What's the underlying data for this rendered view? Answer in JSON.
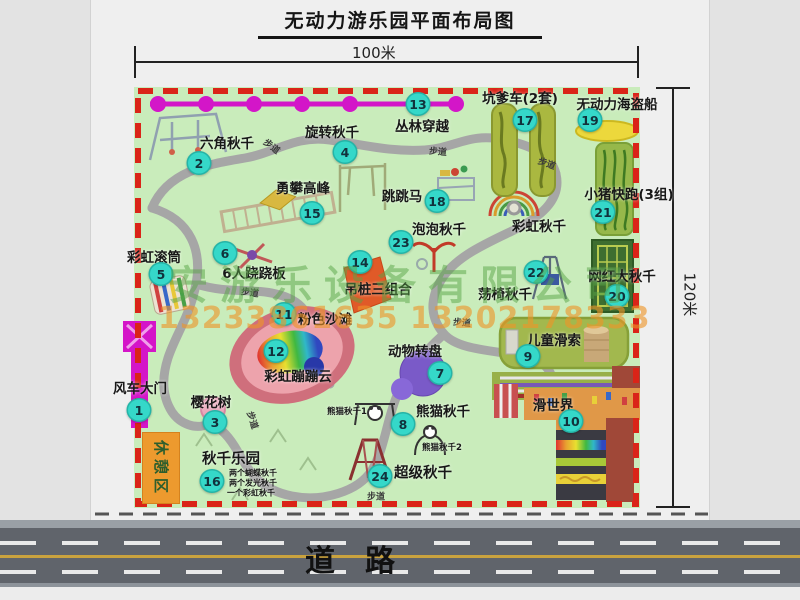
{
  "title": "无动力游乐园平面布局图",
  "dims": {
    "top": "100米",
    "right": "120米"
  },
  "watermark": {
    "company": "安游乐设备有限公司",
    "phone": "13233861635 13202178333"
  },
  "road": {
    "label": "道　路"
  },
  "rest_area": {
    "label": "休憩区"
  },
  "colors": {
    "park_green": "#c9ecbb",
    "border_red": "#da2418",
    "marker_teal": "#35d8c9",
    "zipline_magenta": "#d316c8",
    "gate_magenta": "#d415c8",
    "road_gray": "#60646b",
    "rest_orange": "#ed9a2e",
    "watermark_green": "#58a346",
    "watermark_orange": "#ee9428"
  },
  "map": {
    "markers": [
      {
        "n": "1",
        "x": 139,
        "y": 410
      },
      {
        "n": "2",
        "x": 199,
        "y": 163
      },
      {
        "n": "3",
        "x": 215,
        "y": 422
      },
      {
        "n": "4",
        "x": 345,
        "y": 152
      },
      {
        "n": "5",
        "x": 161,
        "y": 274
      },
      {
        "n": "6",
        "x": 225,
        "y": 253
      },
      {
        "n": "7",
        "x": 440,
        "y": 373
      },
      {
        "n": "8",
        "x": 403,
        "y": 424
      },
      {
        "n": "9",
        "x": 528,
        "y": 356
      },
      {
        "n": "10",
        "x": 571,
        "y": 421
      },
      {
        "n": "11",
        "x": 284,
        "y": 314
      },
      {
        "n": "12",
        "x": 276,
        "y": 351
      },
      {
        "n": "13",
        "x": 418,
        "y": 104
      },
      {
        "n": "14",
        "x": 360,
        "y": 262
      },
      {
        "n": "15",
        "x": 312,
        "y": 213
      },
      {
        "n": "16",
        "x": 212,
        "y": 481
      },
      {
        "n": "17",
        "x": 525,
        "y": 120
      },
      {
        "n": "18",
        "x": 437,
        "y": 201
      },
      {
        "n": "19",
        "x": 590,
        "y": 120
      },
      {
        "n": "20",
        "x": 617,
        "y": 296
      },
      {
        "n": "21",
        "x": 603,
        "y": 212
      },
      {
        "n": "22",
        "x": 536,
        "y": 272
      },
      {
        "n": "23",
        "x": 401,
        "y": 242
      },
      {
        "n": "24",
        "x": 380,
        "y": 476
      }
    ],
    "labels": [
      {
        "t": "六角秋千",
        "x": 227,
        "y": 142
      },
      {
        "t": "旋转秋千",
        "x": 332,
        "y": 131
      },
      {
        "t": "丛林穿越",
        "x": 422,
        "y": 125
      },
      {
        "t": "坑爹车(2套)",
        "x": 520,
        "y": 97
      },
      {
        "t": "无动力海盗船",
        "x": 617,
        "y": 103
      },
      {
        "t": "勇攀高峰",
        "x": 303,
        "y": 187
      },
      {
        "t": "跳跳马",
        "x": 402,
        "y": 195
      },
      {
        "t": "小猪快跑(3组)",
        "x": 629,
        "y": 193
      },
      {
        "t": "彩虹滚筒",
        "x": 154,
        "y": 256
      },
      {
        "t": "6人跷跷板",
        "x": 254,
        "y": 272
      },
      {
        "t": "泡泡秋千",
        "x": 439,
        "y": 228
      },
      {
        "t": "彩虹秋千",
        "x": 539,
        "y": 225
      },
      {
        "t": "吊桩三组合",
        "x": 378,
        "y": 288
      },
      {
        "t": "荡椅秋千",
        "x": 505,
        "y": 293
      },
      {
        "t": "网红大秋千",
        "x": 622,
        "y": 275
      },
      {
        "t": "粉色沙滩",
        "x": 325,
        "y": 318
      },
      {
        "t": "彩虹蹦蹦云",
        "x": 298,
        "y": 375
      },
      {
        "t": "动物转盘",
        "x": 415,
        "y": 350
      },
      {
        "t": "儿童滑索",
        "x": 554,
        "y": 339
      },
      {
        "t": "风车大门",
        "x": 140,
        "y": 387
      },
      {
        "t": "樱花树",
        "x": 211,
        "y": 401
      },
      {
        "t": "熊猫秋千",
        "x": 443,
        "y": 410
      },
      {
        "t": "滑世界",
        "x": 553,
        "y": 404
      },
      {
        "t": "秋千乐园",
        "x": 231,
        "y": 458,
        "s": 14.5
      },
      {
        "t": "超级秋千",
        "x": 423,
        "y": 472,
        "s": 14.5
      },
      {
        "t": "熊猫秋千1",
        "x": 347,
        "y": 411,
        "s": 8.5
      },
      {
        "t": "熊猫秋千2",
        "x": 442,
        "y": 447,
        "s": 8.5
      },
      {
        "t": "两个蝴蝶秋千",
        "x": 253,
        "y": 473,
        "s": 8
      },
      {
        "t": "两个发光秋千",
        "x": 253,
        "y": 483,
        "s": 8
      },
      {
        "t": "一个彩虹秋千",
        "x": 251,
        "y": 493,
        "s": 8
      }
    ],
    "path_labels": [
      {
        "t": "步道",
        "x": 272,
        "y": 146,
        "r": 38
      },
      {
        "t": "步道",
        "x": 438,
        "y": 151,
        "r": 5
      },
      {
        "t": "步道",
        "x": 547,
        "y": 163,
        "r": 20
      },
      {
        "t": "步道",
        "x": 250,
        "y": 292,
        "r": 8
      },
      {
        "t": "步道",
        "x": 462,
        "y": 322,
        "r": 5
      },
      {
        "t": "步道",
        "x": 253,
        "y": 420,
        "r": 72
      },
      {
        "t": "步道",
        "x": 376,
        "y": 496,
        "r": 0
      }
    ]
  }
}
